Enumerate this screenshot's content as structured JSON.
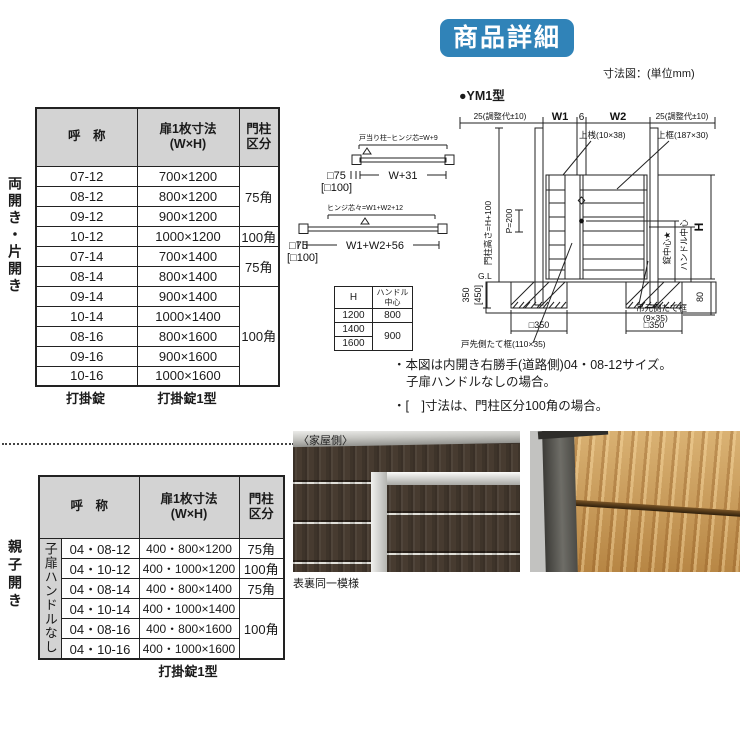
{
  "badge": "商品詳細",
  "unit_note": "寸法図：(単位mm)",
  "model_label": "●YM1型",
  "table1": {
    "side_label": "両開き・片開き",
    "head_name": "呼　称",
    "head_size1": "扉1枚寸法",
    "head_size2": "(W×H)",
    "head_post1": "門柱",
    "head_post2": "区分",
    "rows": [
      {
        "name": "07-12",
        "size": "700×1200"
      },
      {
        "name": "08-12",
        "size": "800×1200"
      },
      {
        "name": "09-12",
        "size": "900×1200"
      },
      {
        "name": "10-12",
        "size": "1000×1200"
      },
      {
        "name": "07-14",
        "size": "700×1400"
      },
      {
        "name": "08-14",
        "size": "800×1400"
      },
      {
        "name": "09-14",
        "size": "900×1400"
      },
      {
        "name": "10-14",
        "size": "1000×1400"
      },
      {
        "name": "08-16",
        "size": "800×1600"
      },
      {
        "name": "09-16",
        "size": "900×1600"
      },
      {
        "name": "10-16",
        "size": "1000×1600"
      }
    ],
    "post_spans": [
      {
        "label": "75角"
      },
      {
        "label": "100角"
      },
      {
        "label": "75角"
      },
      {
        "label": "100角"
      }
    ],
    "footer_left": "打掛錠",
    "footer_right": "打掛錠1型"
  },
  "table2": {
    "side_label": "親子開き",
    "sub_label": "子扉ハンドルなし",
    "head_name": "呼　称",
    "head_size1": "扉1枚寸法",
    "head_size2": "(W×H)",
    "head_post1": "門柱",
    "head_post2": "区分",
    "rows": [
      {
        "name": "04・08-12",
        "size": "400・800×1200",
        "post": "75角"
      },
      {
        "name": "04・10-12",
        "size": "400・1000×1200",
        "post": "100角"
      },
      {
        "name": "04・08-14",
        "size": "400・800×1400",
        "post": "75角"
      },
      {
        "name": "04・10-14",
        "size": "400・1000×1400",
        "post": "100角"
      },
      {
        "name": "04・08-16",
        "size": "400・800×1600"
      },
      {
        "name": "04・10-16",
        "size": "400・1000×1600"
      }
    ],
    "footer": "打掛錠1型"
  },
  "plan": {
    "d1_label": "戸当り柱~ヒンジ芯=W+9",
    "d1_dim": "W+31",
    "d1_col": "□75",
    "d1_col_alt": "[□100]",
    "d2_label": "ヒンジ芯々=W1+W2+12",
    "d2_dim": "W1+W2+56",
    "d2_col": "□75",
    "d2_col_alt": "[□100]"
  },
  "handle_table": {
    "h": "H",
    "handle1": "ハンドル",
    "handle2": "中心",
    "r1c1": "1200",
    "r1c2": "800",
    "r2c1": "1400",
    "r2c2": "900",
    "r3c1": "1600"
  },
  "elevation": {
    "adj_l": "25(調整代±10)",
    "w1": "W1",
    "six": "6",
    "w2": "W2",
    "adj_r": "25(調整代±10)",
    "top_rail": "上桟(10×38)",
    "top_frame": "上框(187×30)",
    "post_height": "門柱高さ=H+100",
    "p200": "P=200",
    "gl": "G.L",
    "d350": "350",
    "d450": "[450]",
    "sq350_l": "□350",
    "sq350_r": "□350",
    "d80": "80",
    "h": "H",
    "lock_center": "錠中心★",
    "handle_center": "ハンドル中心",
    "hinge_stile1": "吊元側たて框",
    "hinge_stile2": "(9×35)",
    "latch_stile": "戸先側たて框(110×35)"
  },
  "notes": {
    "line1": "・本図は内開き右勝手(道路側)04・08-12サイズ。",
    "line2": "子扉ハンドルなしの場合。",
    "line3": "・[　]寸法は、門柱区分100角の場合。"
  },
  "photos": {
    "house_side": "〈家屋側〉",
    "caption": "表裏同一模様"
  }
}
